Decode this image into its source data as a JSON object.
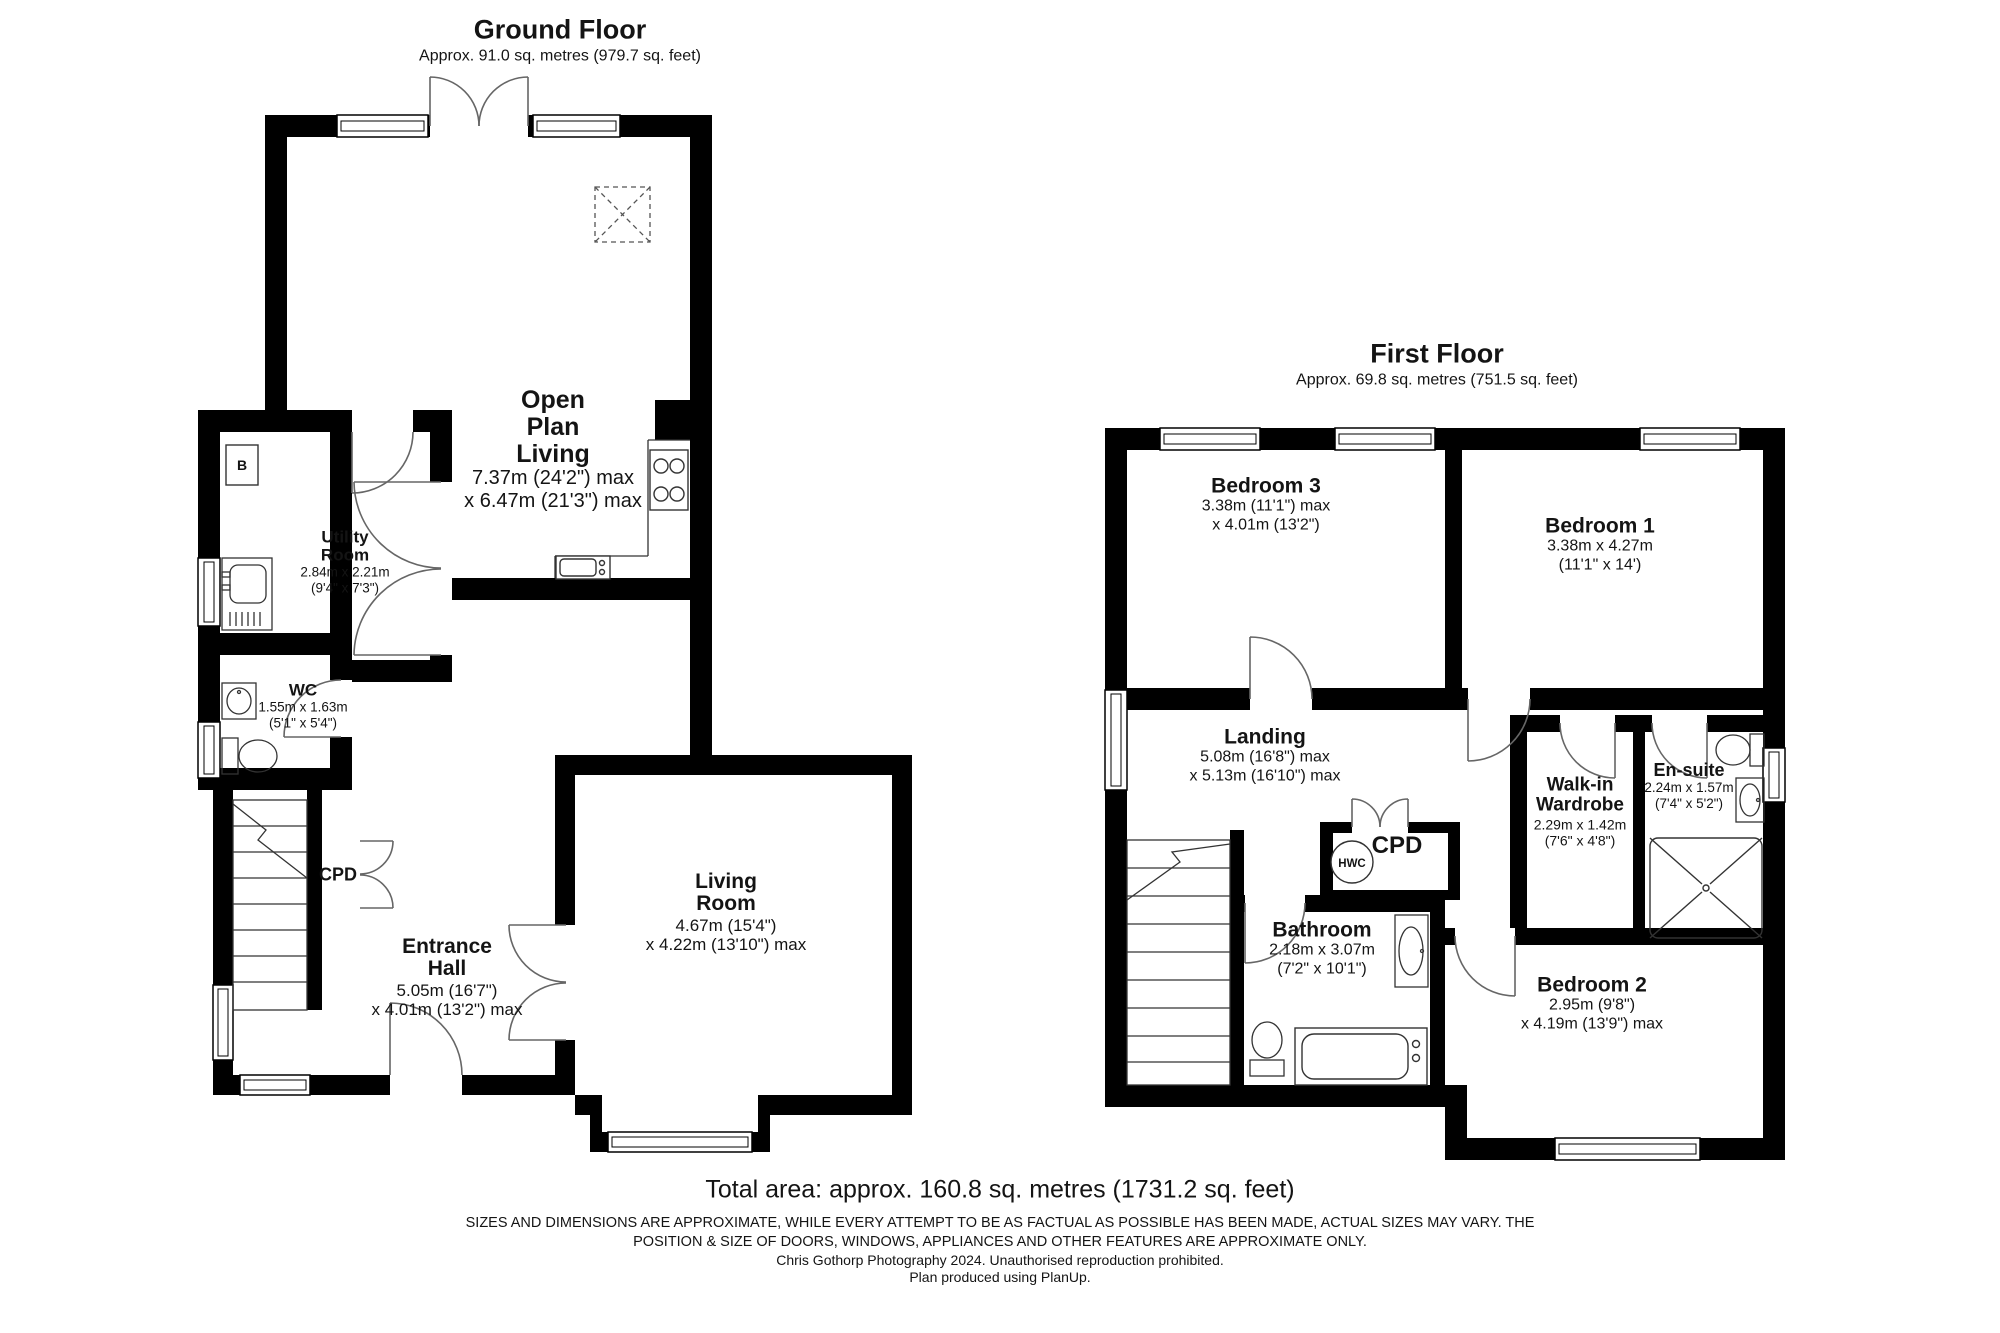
{
  "ground_floor": {
    "title": "Ground Floor",
    "subtitle": "Approx. 91.0 sq. metres (979.7 sq. feet)",
    "rooms": {
      "open_plan_living": {
        "name_lines": [
          "Open",
          "Plan",
          "Living"
        ],
        "dims": [
          "7.37m (24'2\") max",
          "x 6.47m (21'3\") max"
        ]
      },
      "utility_room": {
        "name_lines": [
          "Utility",
          "Room"
        ],
        "dims": [
          "2.84m x 2.21m",
          "(9'4\" x 7'3\")"
        ]
      },
      "wc": {
        "name": "WC",
        "dims": [
          "1.55m x 1.63m",
          "(5'1\" x 5'4\")"
        ]
      },
      "entrance_hall": {
        "name_lines": [
          "Entrance",
          "Hall"
        ],
        "dims": [
          "5.05m (16'7\")",
          "x 4.01m (13'2\") max"
        ]
      },
      "living_room": {
        "name_lines": [
          "Living",
          "Room"
        ],
        "dims": [
          "4.67m (15'4\")",
          "x 4.22m (13'10\") max"
        ]
      },
      "cupboard": "CPD",
      "boiler": "B"
    }
  },
  "first_floor": {
    "title": "First Floor",
    "subtitle": "Approx. 69.8 sq. metres (751.5 sq. feet)",
    "rooms": {
      "bedroom_3": {
        "name": "Bedroom 3",
        "dims": [
          "3.38m (11'1\") max",
          "x 4.01m (13'2\")"
        ]
      },
      "bedroom_1": {
        "name": "Bedroom 1",
        "dims": [
          "3.38m x 4.27m",
          "(11'1\" x 14')"
        ]
      },
      "landing": {
        "name": "Landing",
        "dims": [
          "5.08m (16'8\") max",
          "x 5.13m (16'10\") max"
        ]
      },
      "walk_in_wardrobe": {
        "name_lines": [
          "Walk-in",
          "Wardrobe"
        ],
        "dims": [
          "2.29m x 1.42m",
          "(7'6\" x 4'8\")"
        ]
      },
      "en_suite": {
        "name": "En-suite",
        "dims": [
          "2.24m x 1.57m",
          "(7'4\" x 5'2\")"
        ]
      },
      "bathroom": {
        "name": "Bathroom",
        "dims": [
          "2.18m x 3.07m",
          "(7'2\" x 10'1\")"
        ]
      },
      "bedroom_2": {
        "name": "Bedroom 2",
        "dims": [
          "2.95m (9'8\")",
          "x 4.19m (13'9\") max"
        ]
      },
      "cupboard": "CPD",
      "hot_water_cylinder": "HWC"
    }
  },
  "footer": {
    "total_area": "Total area: approx. 160.8 sq. metres (1731.2 sq. feet)",
    "disclaimer_line1": "SIZES AND DIMENSIONS ARE APPROXIMATE, WHILE EVERY ATTEMPT TO BE AS FACTUAL AS POSSIBLE HAS BEEN MADE, ACTUAL SIZES MAY VARY. THE",
    "disclaimer_line2": "POSITION & SIZE OF DOORS, WINDOWS, APPLIANCES AND OTHER FEATURES ARE APPROXIMATE ONLY.",
    "credit_line1": "Chris Gothorp Photography 2024. Unauthorised reproduction prohibited.",
    "credit_line2": "Plan produced using PlanUp."
  }
}
